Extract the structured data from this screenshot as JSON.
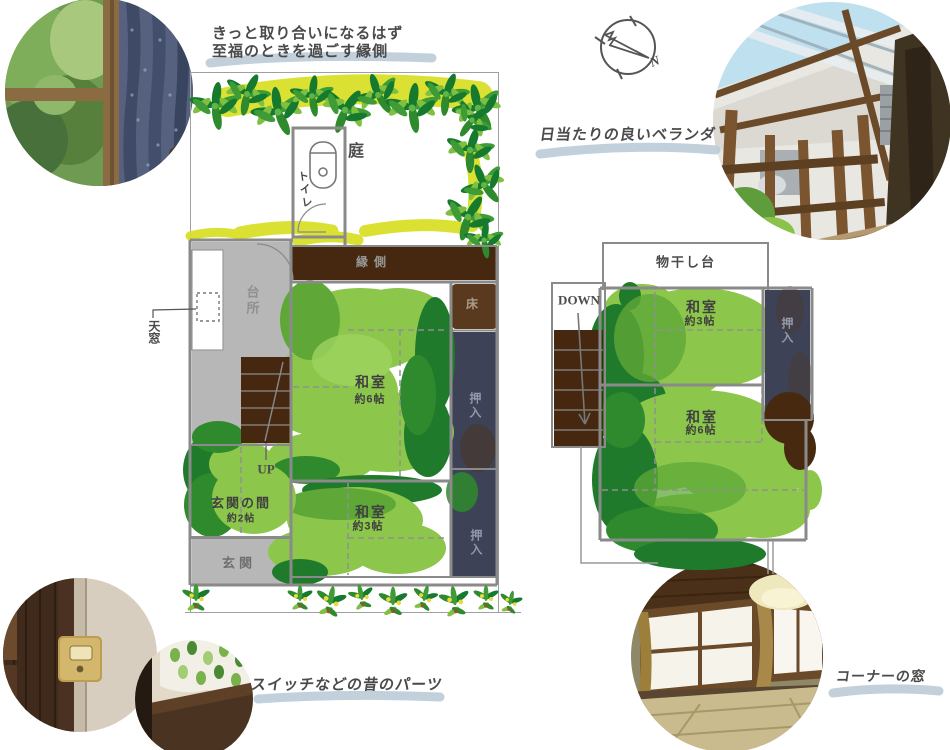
{
  "annotations": {
    "engawa_note_line1": "きっと取り合いになるはず",
    "engawa_note_line2": "至福のときを過ごす縁側",
    "veranda_note": "日当たりの良いベランダ",
    "parts_note": "スイッチなどの昔のパーツ",
    "corner_window_note": "コーナーの窓"
  },
  "compass": {
    "north_label": "N"
  },
  "floor1": {
    "garden": "庭",
    "toilet": "トイレ",
    "engawa": "縁側",
    "kitchen": "台所",
    "skylight": "天窓",
    "tokonoma": "床",
    "closet_upper": "押入",
    "closet_lower": "押入",
    "room6": {
      "name": "和室",
      "size": "約6帖"
    },
    "room3": {
      "name": "和室",
      "size": "約3帖"
    },
    "entrance_hall": {
      "name": "玄関の間",
      "size": "約2帖"
    },
    "entrance": "玄関",
    "up_label": "UP"
  },
  "floor2": {
    "drying_deck": "物干し台",
    "down_label": "DOWN",
    "room3": {
      "name": "和室",
      "size": "約3帖"
    },
    "room6": {
      "name": "和室",
      "size": "約6帖"
    },
    "closet": "押入"
  },
  "colors": {
    "paint_light_green": "#8CC64B",
    "paint_mid_green": "#5FA838",
    "paint_dark_green": "#1F7A2B",
    "highlight_chartreuse": "#D7DF21",
    "engawa_brown": "#45280F",
    "tokonoma_brown": "#5A3A1E",
    "closet_navy": "#3D4257",
    "room_gray": "#B7B7B7",
    "wall_gray": "#8A8A8A",
    "label_gray": "#4A4A4A",
    "brush_underline_blue": "#BECDD9"
  }
}
